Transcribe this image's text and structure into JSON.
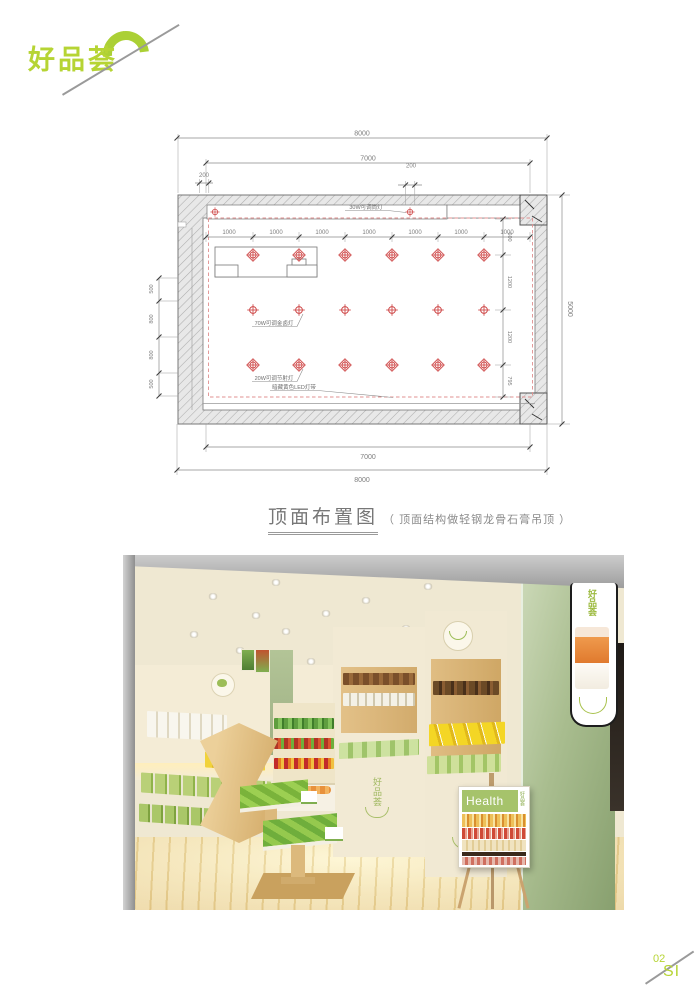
{
  "brand": {
    "logo_text": "好品荟"
  },
  "plan": {
    "caption": {
      "title": "顶面布置图",
      "note": "（ 顶面结构做轻钢龙骨石膏吊顶 ）"
    },
    "dims": {
      "outer_width": "8000",
      "inner_width": "7000",
      "offset_left": "200",
      "offset_mid": "200",
      "bay": "1000",
      "outer_height": "5000",
      "right_chain": [
        "600",
        "1200",
        "1200",
        "795"
      ],
      "left_chain": [
        "500",
        "800",
        "800",
        "500"
      ],
      "bottom_inner": "7000",
      "bottom_outer": "8000"
    },
    "light_labels": {
      "downlight": "30W可调筒灯",
      "metal_halide": "70W可调金卤灯",
      "spotlight": "20W可调节射灯",
      "led_strip": "暗藏黄色LED灯带"
    }
  },
  "photo": {
    "poster": {
      "title": "Health",
      "side_text": "好品荟"
    },
    "lightbox_brand": "好品荟",
    "cabinet_brand": "好品荟"
  },
  "footer": {
    "page_number": "02",
    "page_mark": "SI"
  },
  "colors": {
    "brand_green": "#b6d434",
    "plan_symbol_red": "#cf4a4a",
    "sage": "#a9bd8f"
  }
}
